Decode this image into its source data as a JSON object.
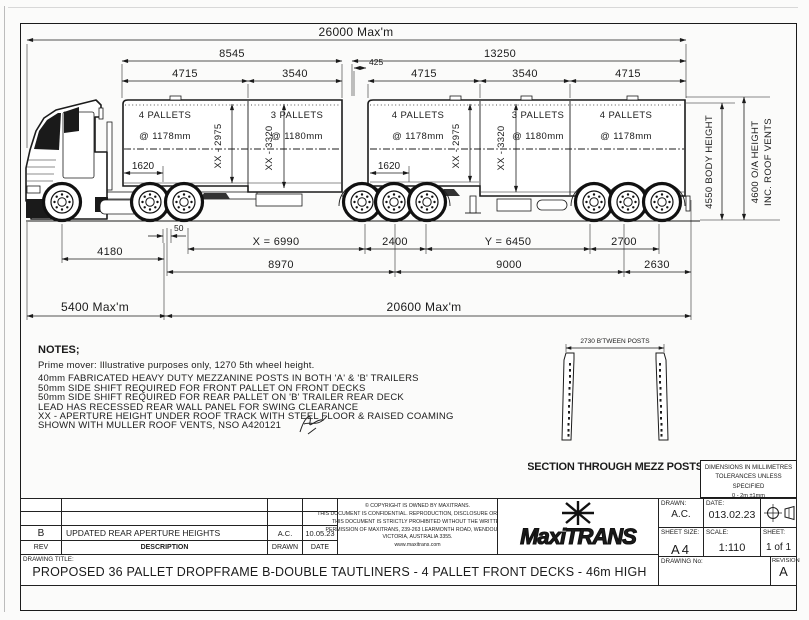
{
  "sheet": {
    "dims": {
      "overall_top": "26000 Max'm",
      "lead_length": "8545",
      "b_length": "13250",
      "gap": "425",
      "a_front": "4715",
      "a_rear": "3540",
      "b_front": "4715",
      "b_mid": "3540",
      "b_rear": "4715",
      "a_offset": "1620",
      "b_offset": "1620",
      "steer_to_drive": "4180",
      "fifty": "50",
      "x_dim": "X = 6990",
      "dim_2400": "2400",
      "y_dim": "Y = 6450",
      "dim_2700": "2700",
      "lead_wheelbase": "8970",
      "b_wheelbase": "9000",
      "rear_overhang": "2630",
      "prime_mover": "5400 Max'm",
      "combination": "20600 Max'm",
      "body_height": "4550 BODY HEIGHT",
      "oa_height_line1": "4600 O/A HEIGHT",
      "oa_height_line2": "INC. ROOF VENTS"
    },
    "pallets": {
      "a1": "4 PALLETS",
      "a1_pitch": "@ 1178mm",
      "a1_aperture": "XX - 2975",
      "a2": "3 PALLETS",
      "a2_pitch": "@ 1180mm",
      "a2_aperture": "XX - 3320",
      "b1": "4 PALLETS",
      "b1_pitch": "@ 1178mm",
      "b1_aperture": "XX - 2975",
      "b2": "3 PALLETS",
      "b2_pitch": "@ 1180mm",
      "b2_aperture": "XX - 3320",
      "b3": "4 PALLETS",
      "b3_pitch": "@ 1178mm"
    },
    "notes": {
      "heading": "NOTES;",
      "lines": [
        "Prime mover: Illustrative purposes only, 1270 5th wheel height.",
        "40mm FABRICATED HEAVY DUTY MEZZANINE POSTS IN BOTH 'A' & 'B' TRAILERS",
        "50mm SIDE SHIFT REQUIRED FOR FRONT PALLET ON FRONT DECKS",
        "50mm SIDE SHIFT REQUIRED FOR REAR PALLET ON 'B' TRAILER REAR DECK",
        "LEAD HAS RECESSED REAR WALL PANEL FOR SWING CLEARANCE",
        "XX - APERTURE HEIGHT UNDER ROOF TRACK WITH STEEL FLOOR & RAISED COAMING",
        "SHOWN WITH MULLER ROOF VENTS, NSO A420121"
      ]
    },
    "section_detail": {
      "dim": "2730 B'TWEEN POSTS",
      "caption": "SECTION THROUGH MEZZ POSTS"
    },
    "tolerance_box": {
      "lines": [
        "DIMENSIONS IN MILLIMETRES",
        "TOLERANCES UNLESS SPECIFIED",
        "0 - 2m ±1mm",
        "+2m ±0.5mm/metre"
      ]
    },
    "title_block": {
      "rev_row": {
        "rev": "B",
        "description": "UPDATED REAR APERTURE HEIGHTS",
        "drawn": "A.C.",
        "date": "10.05.23"
      },
      "headers": {
        "rev": "REV",
        "description": "DESCRIPTION",
        "drawn": "DRAWN",
        "date": "DATE"
      },
      "copyright_lines": [
        "© COPYRIGHT IS OWNED BY MAXITRANS.",
        "THIS DOCUMENT IS CONFIDENTIAL. REPRODUCTION, DISCLOSURE OR USE OF",
        "THIS DOCUMENT IS STRICTLY PROHIBITED WITHOUT THE WRITTEN",
        "PERMISSION OF MAXITRANS, 239-263 LEARMONTH ROAD, WENDOUREE,",
        "VICTORIA, AUSTRALIA 3355.",
        "www.maxitrans.com"
      ],
      "logo_text": "MaxiTRANS",
      "drawn_label": "DRAWN:",
      "drawn": "A.C.",
      "date_label": "DATE:",
      "date": "013.02.23",
      "sheet_size_label": "SHEET SIZE:",
      "sheet_size": "A4",
      "scale_label": "SCALE:",
      "scale": "1:110",
      "sheet_label": "SHEET:",
      "sheet": "1 of 1",
      "drawing_no_label": "DRAWING No:",
      "revision_label": "REVISION",
      "revision": "A",
      "drawing_title_label": "DRAWING TITLE:",
      "title": "PROPOSED 36 PALLET DROPFRAME B-DOUBLE TAUTLINERS - 4 PALLET FRONT DECKS - 46m HIGH"
    },
    "colors": {
      "line": "#1b1b1b",
      "paper": "#ffffff"
    }
  }
}
